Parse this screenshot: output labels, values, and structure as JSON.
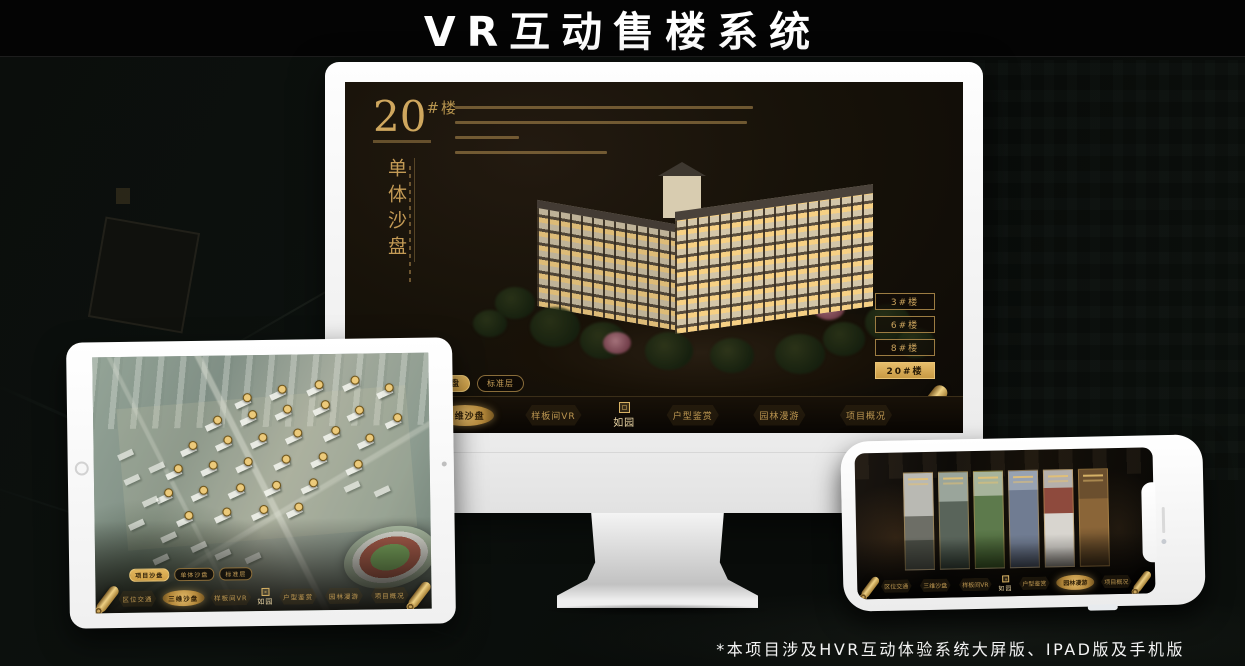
{
  "title": "VR互动售楼系统",
  "footnote": "*本项目涉及HVR互动体验系统大屏版、IPAD版及手机版",
  "brand": {
    "name": "如园"
  },
  "colors": {
    "gold": "#caa35c",
    "gold_bright": "#e6bd6b",
    "active_tab_bg": "#d9a94e",
    "screen_bg": "#14100a"
  },
  "monitor": {
    "headline": {
      "number": "20",
      "suffix": "#楼",
      "vertical": "单体沙盘"
    },
    "floor_buttons": [
      {
        "label": "3#楼",
        "active": false
      },
      {
        "label": "6#楼",
        "active": false
      },
      {
        "label": "8#楼",
        "active": false
      },
      {
        "label": "20#楼",
        "active": true
      }
    ],
    "tabs": [
      {
        "label": "项目沙盘",
        "active": false
      },
      {
        "label": "单体沙盘",
        "active": true
      },
      {
        "label": "标准层",
        "active": false
      }
    ],
    "nav": [
      {
        "label": "区位交通",
        "active": false
      },
      {
        "label": "三维沙盘",
        "active": true
      },
      {
        "label": "样板间VR",
        "active": false
      },
      {
        "label": "户型鉴赏",
        "active": false
      },
      {
        "label": "园林漫游",
        "active": false
      },
      {
        "label": "项目概况",
        "active": false
      }
    ]
  },
  "tablet": {
    "tabs": [
      {
        "label": "项目沙盘",
        "active": true
      },
      {
        "label": "单体沙盘",
        "active": false
      },
      {
        "label": "标准层",
        "active": false
      }
    ],
    "nav": [
      {
        "label": "区位交通",
        "active": false
      },
      {
        "label": "三维沙盘",
        "active": true
      },
      {
        "label": "样板间VR",
        "active": false
      },
      {
        "label": "户型鉴赏",
        "active": false
      },
      {
        "label": "园林漫游",
        "active": false
      },
      {
        "label": "项目概况",
        "active": false
      }
    ]
  },
  "phone": {
    "nav": [
      {
        "label": "区位交通",
        "active": false
      },
      {
        "label": "三维沙盘",
        "active": false
      },
      {
        "label": "样板间VR",
        "active": false
      },
      {
        "label": "户型鉴赏",
        "active": false
      },
      {
        "label": "园林漫游",
        "active": true
      },
      {
        "label": "项目概况",
        "active": false
      }
    ]
  }
}
